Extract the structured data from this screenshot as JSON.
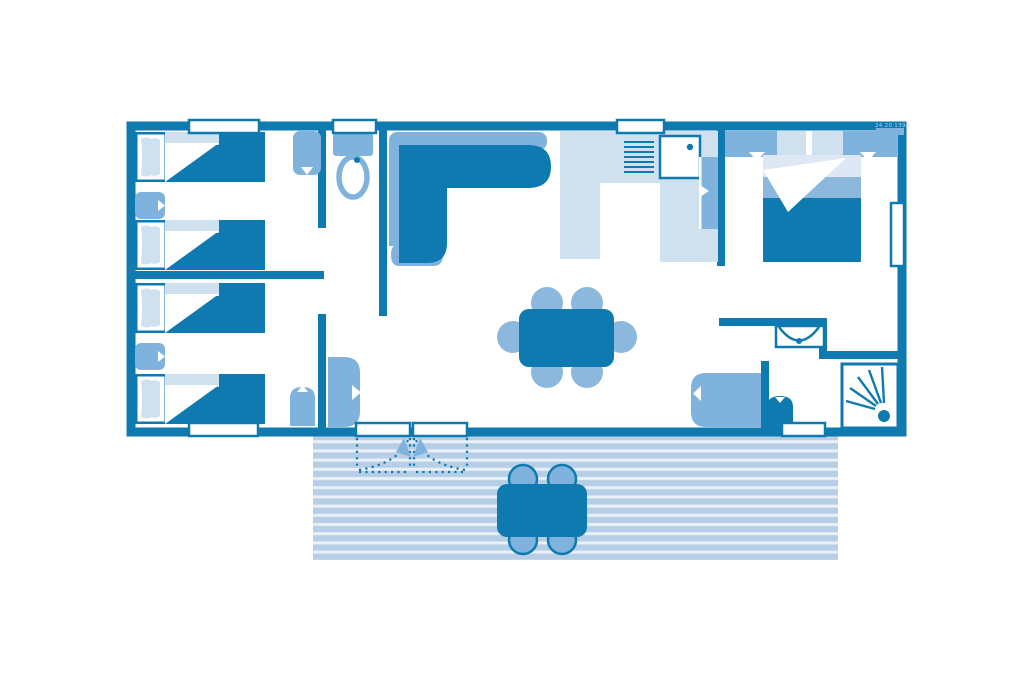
{
  "diagram": {
    "type": "floor-plan",
    "title": "Mobile home floor plan with terrace",
    "watermark": "24 20 1396",
    "rooms": [
      {
        "id": "bedroom-twin-1",
        "label": "Twin bedroom 1"
      },
      {
        "id": "bedroom-twin-2",
        "label": "Twin bedroom 2"
      },
      {
        "id": "hallway",
        "label": "Hallway"
      },
      {
        "id": "wc",
        "label": "WC"
      },
      {
        "id": "living-room",
        "label": "Living room"
      },
      {
        "id": "kitchen",
        "label": "Kitchen"
      },
      {
        "id": "master-bedroom",
        "label": "Master bedroom"
      },
      {
        "id": "shower-room",
        "label": "Shower room"
      },
      {
        "id": "terrace",
        "label": "Terrace"
      }
    ],
    "furniture": {
      "single_beds": 4,
      "double_beds": 1,
      "dining_chairs": 6,
      "terrace_chairs": 4,
      "tables": 2,
      "sofa": "corner sofa",
      "fixtures": [
        "toilet",
        "washbasin",
        "shower",
        "kitchen sink",
        "drainer",
        "fridge",
        "water heater",
        "wardrobes"
      ]
    },
    "colors": {
      "dark": "#0f7ab0",
      "med": "#7fb2dc",
      "light": "#cfe0ef",
      "pale": "#dde8f4",
      "chair": "#8cb8de",
      "terrace": "#b7cfe6",
      "terraceBg": "#e9f0f8",
      "white": "#ffffff",
      "wmText": "#b5d2e8"
    }
  }
}
